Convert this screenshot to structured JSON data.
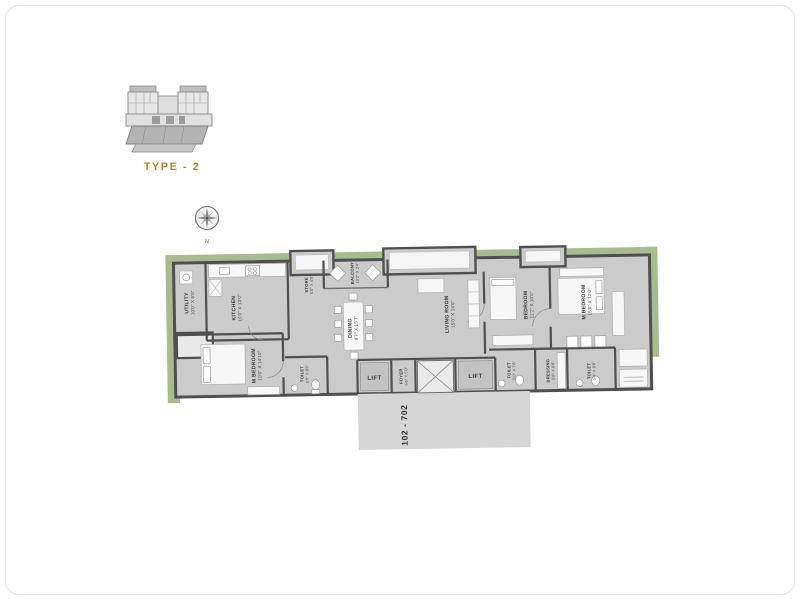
{
  "keyplan": {
    "label": "TYPE - 2"
  },
  "compass": {
    "north_label": "N"
  },
  "floorplan": {
    "unit_range": "102 - 702",
    "colors": {
      "landscape_green": "#a8ba8e",
      "floor_gray": "#cbcbcb",
      "wall_gray": "#4f4f4f",
      "lobby_gray": "#d6d6d6",
      "accent_gold": "#a18c34"
    },
    "rooms": {
      "utility": {
        "name": "UTILITY",
        "dims": "10'0\" X 5'0\""
      },
      "kitchen": {
        "name": "KITCHEN",
        "dims": "10'0\" X 13'0\""
      },
      "store": {
        "name": "STORE",
        "dims": "5'0\" X 4'0\""
      },
      "balcony": {
        "name": "BALCONY",
        "dims": "10'2\" X 3'4\""
      },
      "dining": {
        "name": "DINING",
        "dims": "9'7\" X 15'7\""
      },
      "m_bedroom_left": {
        "name": "M BEDROOM",
        "dims": "10'0\" X 14'10\""
      },
      "toilet_left": {
        "name": "TOILET",
        "dims": "5'0\" X 8'0\""
      },
      "foyer": {
        "name": "FOYER",
        "dims": "5'6\" X 5'0\""
      },
      "lift_left": {
        "name": "LIFT"
      },
      "lift_right": {
        "name": "LIFT"
      },
      "living_room": {
        "name": "LIVING ROOM",
        "dims": "15'0\" X 14'6\""
      },
      "bedroom": {
        "name": "BEDROOM",
        "dims": "11'2\" X 10'0\""
      },
      "m_bedroom_right": {
        "name": "M BEDROOM",
        "dims": "15'0\" X 12'0\""
      },
      "toilet_mid": {
        "name": "TOILET",
        "dims": "5'0\" X 7'6\""
      },
      "dressing": {
        "name": "DRESSING",
        "dims": "5'6\" X 8'6\""
      },
      "toilet_right": {
        "name": "TOILET",
        "dims": "5'0\" X 8'6\""
      }
    }
  }
}
